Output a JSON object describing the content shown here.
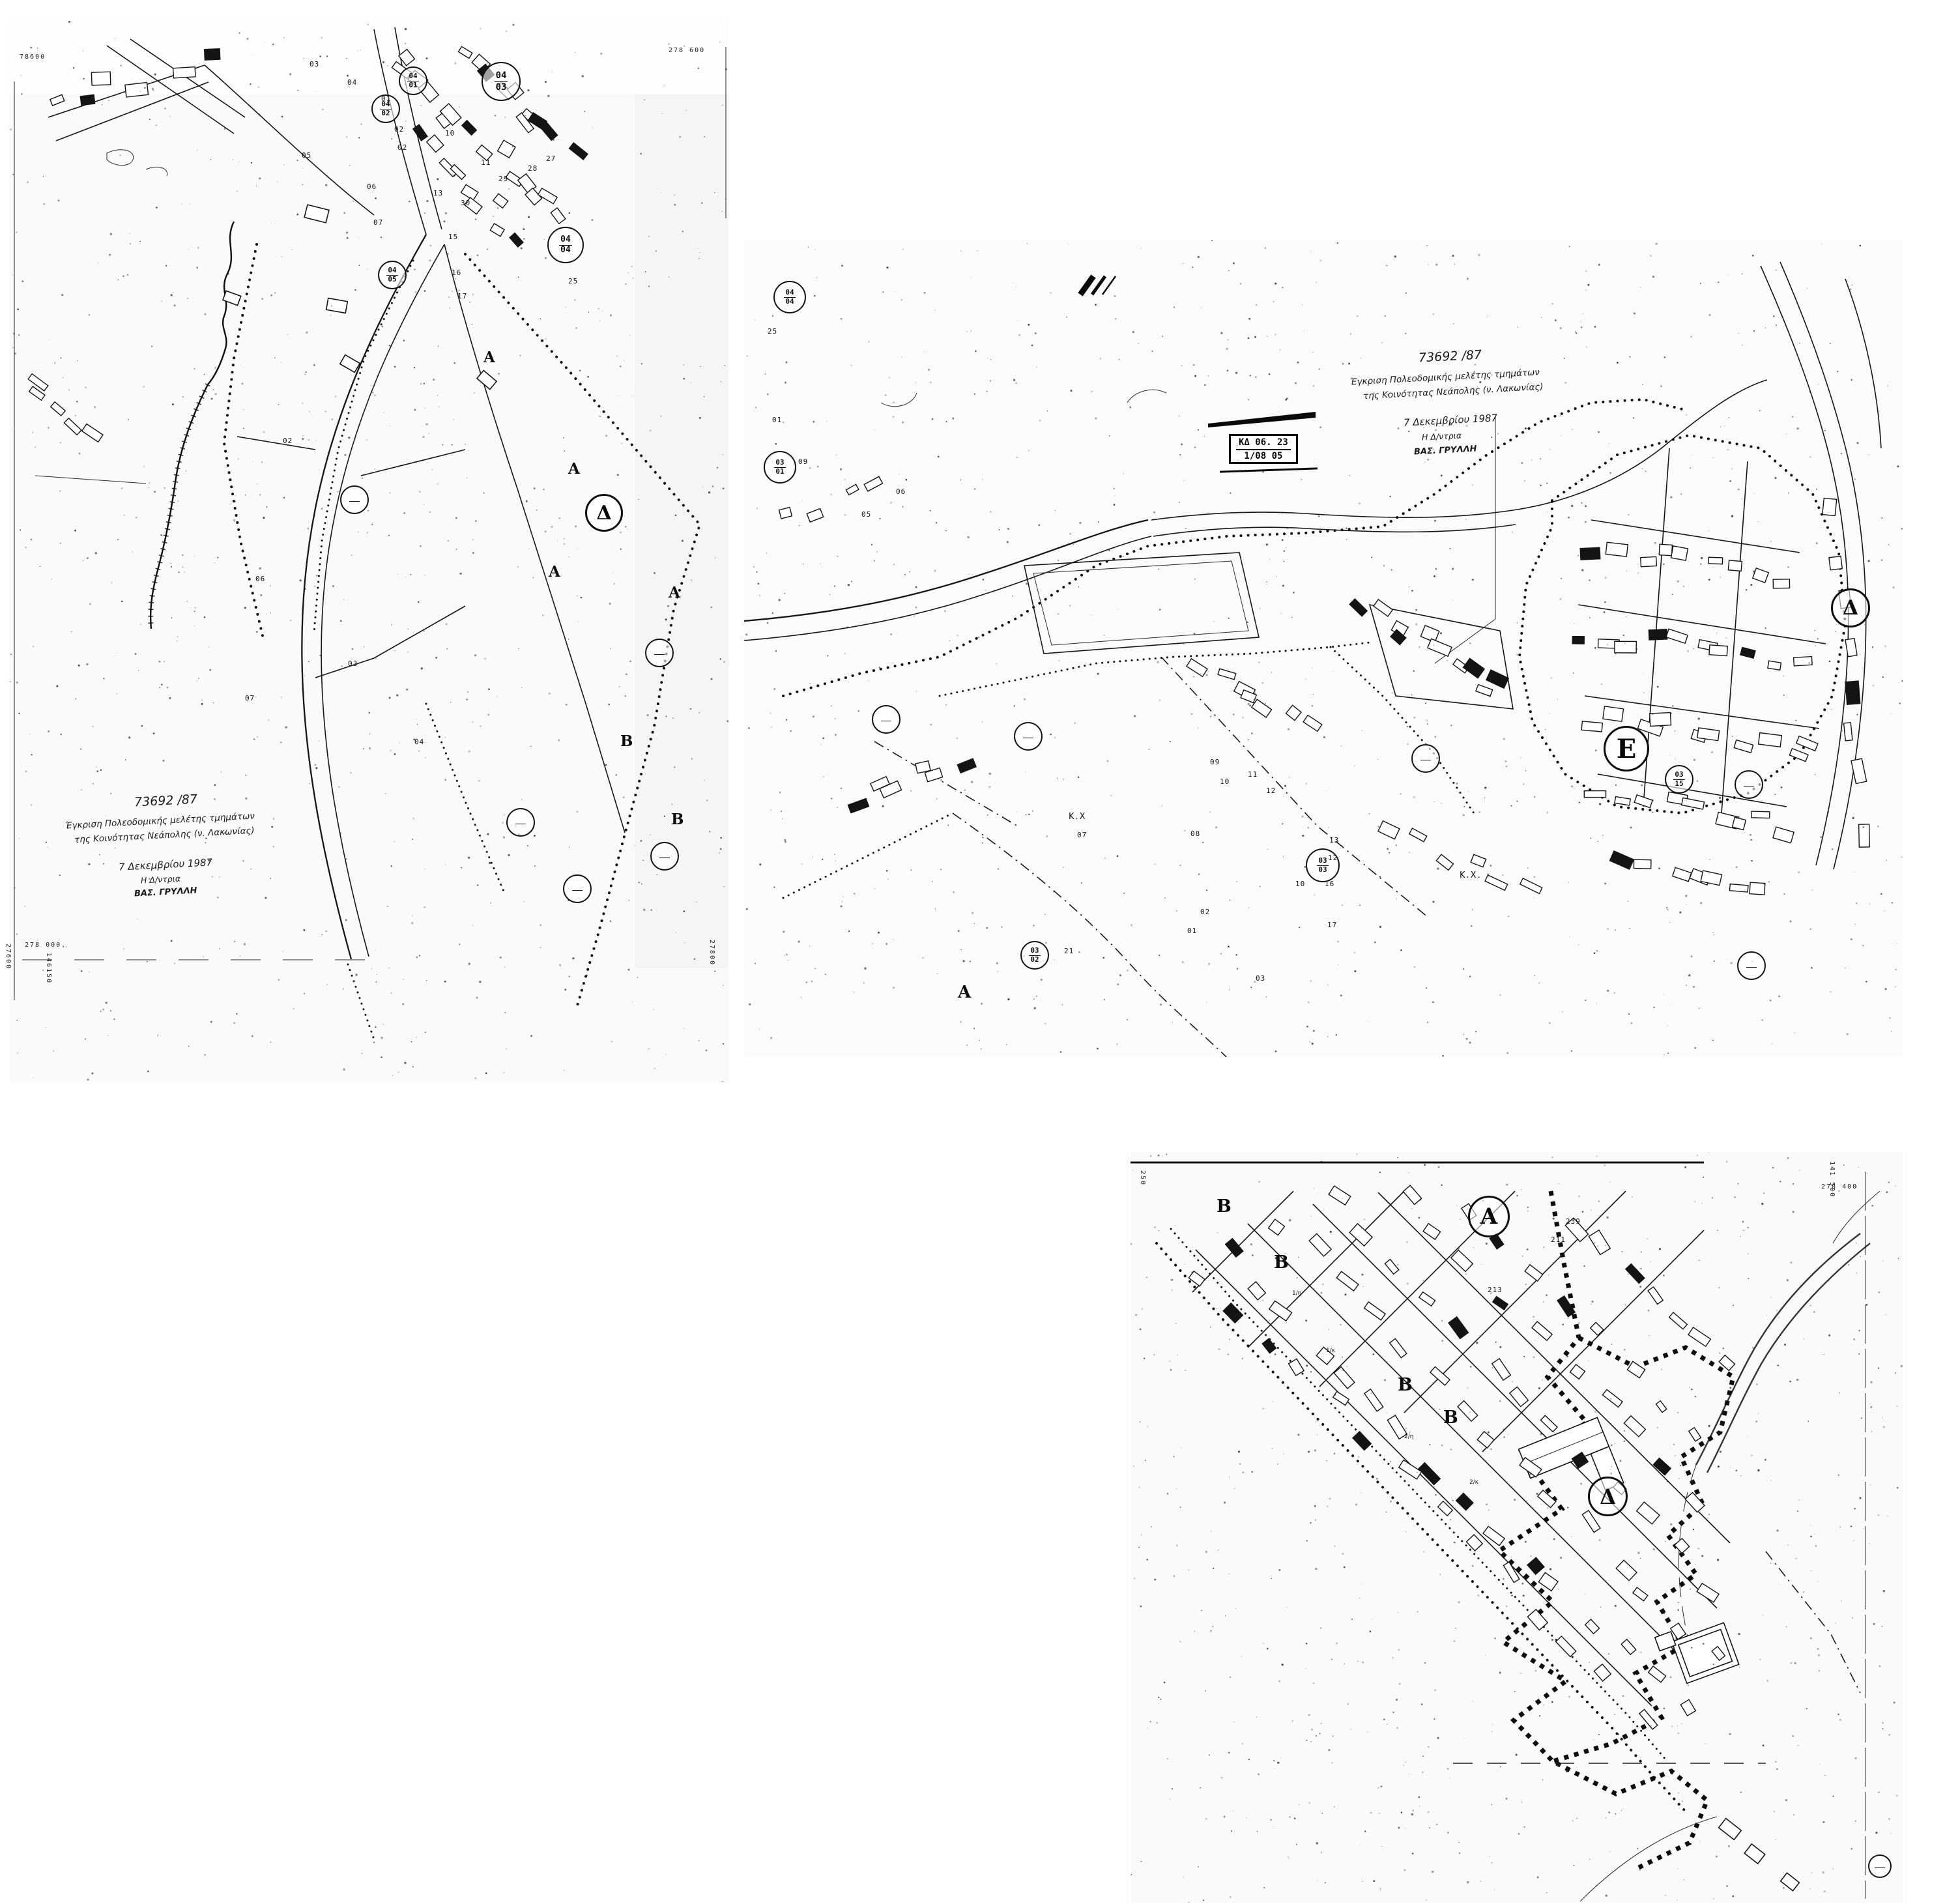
{
  "palette": {
    "ink": "#141414",
    "paper": "#ffffff",
    "sheet": "#fdfdfc"
  },
  "approval": {
    "protocol": "73692 /87",
    "line1": "Έγκριση Πολεοδομικής μελέτης τμημάτων",
    "line2": "της Κοινότητας Νεάπολης (ν. Λακωνίας)",
    "date": "7 Δεκεμβρίου 1987",
    "signature_role": "Η Δ/ντρια",
    "signature_name": "ΒΑΣ. ΓΡΥΛΛΗ"
  },
  "sheets": {
    "left": {
      "grid_labels": {
        "top_left": "78600",
        "top_right": "278 600",
        "bottom_left": "278 000.",
        "bottom_left_vertical": "146150",
        "left_edge_vertical": "27600",
        "bottom_right_vertical": "27800"
      },
      "zones": [
        {
          "label": "Α"
        },
        {
          "label": "Α"
        },
        {
          "label": "Α"
        },
        {
          "label": "Α"
        },
        {
          "label": "Δ"
        },
        {
          "label": "Β"
        },
        {
          "label": "Β"
        }
      ],
      "blocks": [
        {
          "top": "04",
          "bottom": "01"
        },
        {
          "top": "04",
          "bottom": "02"
        },
        {
          "top": "04",
          "bottom": "03"
        },
        {
          "top": "04",
          "bottom": "04"
        },
        {
          "top": "04",
          "bottom": "05"
        }
      ],
      "parcels": [
        "03",
        "04",
        "01",
        "02",
        "02",
        "05",
        "06",
        "07",
        "10",
        "11",
        "13",
        "15",
        "16",
        "17",
        "25",
        "27",
        "28",
        "29",
        "30"
      ]
    },
    "center": {
      "stamp": {
        "line1": "ΚΔ 06. 23",
        "line2": "1/08 05"
      },
      "zones": [
        {
          "label": "Δ"
        },
        {
          "label": "Ε"
        },
        {
          "label": "Α"
        }
      ],
      "area_labels": [
        "Κ.Χ",
        "Κ.Χ."
      ],
      "blocks": [
        {
          "top": "04",
          "bottom": "04"
        },
        {
          "top": "03",
          "bottom": "01"
        },
        {
          "top": "03",
          "bottom": "02"
        },
        {
          "top": "03",
          "bottom": "03"
        },
        {
          "top": "03",
          "bottom": "15"
        }
      ],
      "parcels": [
        "25",
        "01",
        "09",
        "06",
        "05",
        "07",
        "08",
        "09",
        "10",
        "11",
        "12",
        "21",
        "02",
        "01",
        "03",
        "13",
        "12",
        "16",
        "10",
        "17"
      ]
    },
    "bottom": {
      "grid_labels": {
        "top_right_horizontal": "278 400",
        "top_right_vertical": "141 500",
        "top_left_vertical": "250"
      },
      "zones": [
        {
          "label": "Α"
        },
        {
          "label": "Δ"
        },
        {
          "label": "Β"
        },
        {
          "label": "Β"
        },
        {
          "label": "Β"
        },
        {
          "label": "Β"
        }
      ],
      "plot_numbers": [
        "239",
        "211",
        "213"
      ],
      "floor_labels": [
        "1/κ",
        "1/η",
        "2/η",
        "2/κ"
      ]
    }
  }
}
